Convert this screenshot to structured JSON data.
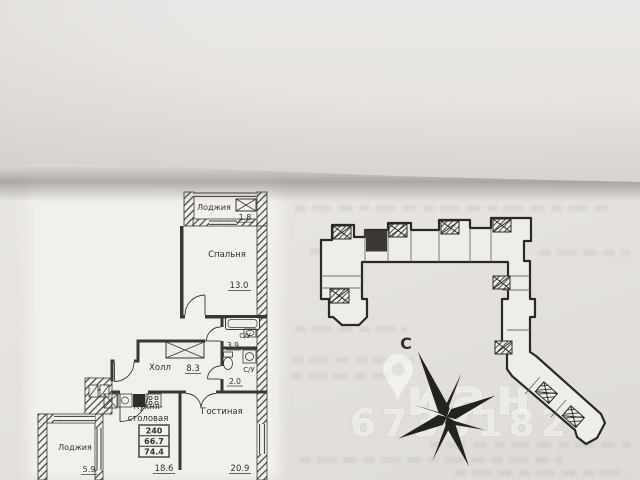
{
  "floor_plan": {
    "loggia_top": {
      "label": "Лоджия",
      "area": "1.8"
    },
    "bedroom": {
      "label": "Спальня",
      "area": "13.0"
    },
    "bathroom_1": {
      "label": "С/У",
      "area": "3.9"
    },
    "bathroom_2": {
      "label": "С/У",
      "area": "2.0"
    },
    "hall": {
      "label": "Холл",
      "area": "8.3"
    },
    "kitchen": {
      "label_line_1": "Кухня-",
      "label_line_2": "столовая",
      "area": "18.6"
    },
    "living_room": {
      "label": "Гостиная",
      "area": "20.9"
    },
    "loggia_bottom": {
      "label": "Лоджия",
      "area": "5.9"
    },
    "stamp": {
      "row_1": "240",
      "row_2": "66.7",
      "row_3": "74.4"
    }
  },
  "site_plan": {
    "compass_north_label": "С"
  },
  "watermark": {
    "brand_fragment": "иан",
    "digits_fragment": "6733182"
  },
  "colors": {
    "ink": "#34312d",
    "plan_stroke": "#2b2927",
    "paper": "#e7e4e0",
    "highlight_unit": "#3b3835"
  }
}
